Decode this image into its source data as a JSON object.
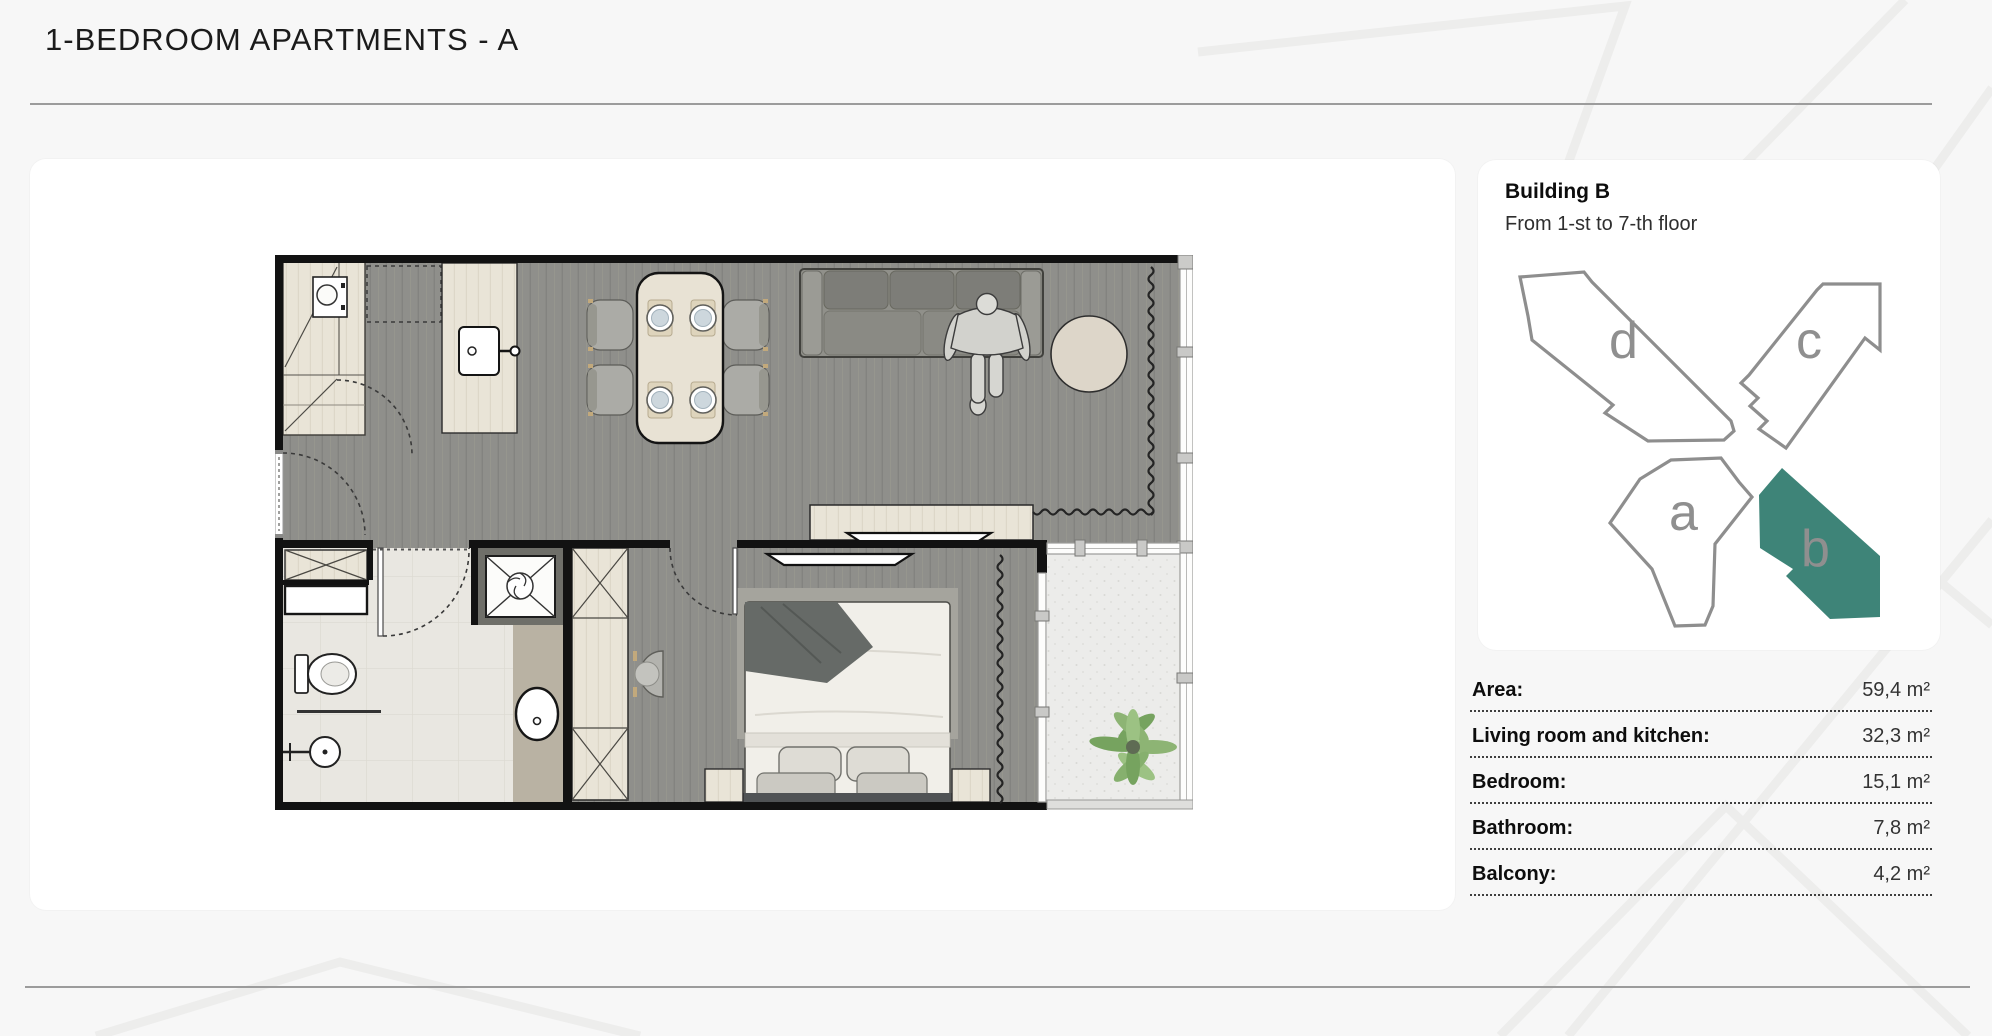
{
  "page": {
    "title": "1-BEDROOM APARTMENTS - A"
  },
  "building": {
    "name": "Building B",
    "floor_range": "From 1-st to 7-th floor",
    "highlight_color": "#3e8478",
    "sections": [
      {
        "label": "d",
        "highlighted": false
      },
      {
        "label": "c",
        "highlighted": false
      },
      {
        "label": "a",
        "highlighted": false
      },
      {
        "label": "b",
        "highlighted": true
      }
    ]
  },
  "apartment_details": {
    "rows": [
      {
        "label": "Area:",
        "value": "59,4 m²"
      },
      {
        "label": "Living room and kitchen:",
        "value": "32,3 m²"
      },
      {
        "label": "Bedroom:",
        "value": "15,1 m²"
      },
      {
        "label": "Bathroom:",
        "value": "7,8 m²"
      },
      {
        "label": "Balcony:",
        "value": "4,2 m²"
      }
    ]
  }
}
